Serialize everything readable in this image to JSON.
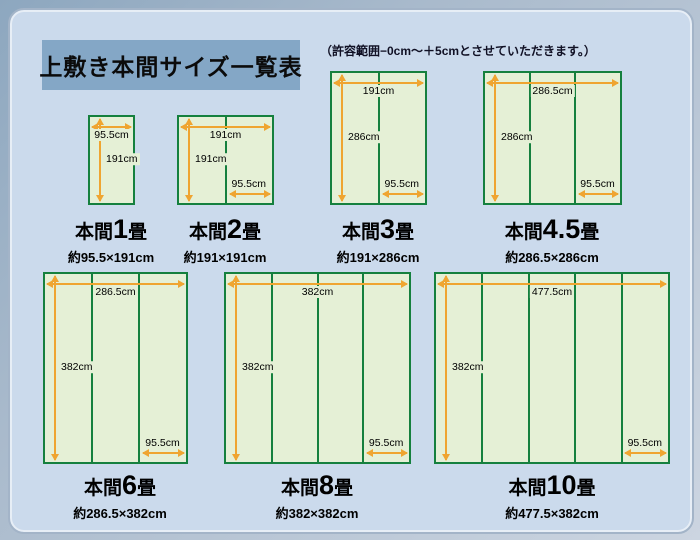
{
  "page": {
    "title": "上敷き本間サイズ一覧表",
    "note": "（許容範囲−0cm〜＋5cmとさせていただきます。）"
  },
  "colors": {
    "panel_background": "#cbdaec",
    "title_box_background": "#84a7c6",
    "mat_fill": "#e5f0d6",
    "mat_border_green": "#15803e",
    "arrow_orange": "#efa531"
  },
  "mats": [
    {
      "id": "honma-1jo",
      "columns": 1,
      "name_prefix": "本間",
      "name_num": "1",
      "name_suffix": "畳",
      "size_label": "約95.5×191cm",
      "width_label": "95.5cm",
      "height_label": "191cm"
    },
    {
      "id": "honma-2jo",
      "columns": 2,
      "name_prefix": "本間",
      "name_num": "2",
      "name_suffix": "畳",
      "size_label": "約191×191cm",
      "width_label": "191cm",
      "height_label": "191cm",
      "bottom_label": "95.5cm"
    },
    {
      "id": "honma-3jo",
      "columns": 2,
      "name_prefix": "本間",
      "name_num": "3",
      "name_suffix": "畳",
      "size_label": "約191×286cm",
      "width_label": "191cm",
      "height_label": "286cm",
      "bottom_label": "95.5cm"
    },
    {
      "id": "honma-4_5jo",
      "columns": 3,
      "name_prefix": "本間",
      "name_num": "4.5",
      "name_suffix": "畳",
      "size_label": "約286.5×286cm",
      "width_label": "286.5cm",
      "height_label": "286cm",
      "bottom_label": "95.5cm"
    },
    {
      "id": "honma-6jo",
      "columns": 3,
      "name_prefix": "本間",
      "name_num": "6",
      "name_suffix": "畳",
      "size_label": "約286.5×382cm",
      "width_label": "286.5cm",
      "height_label": "382cm",
      "bottom_label": "95.5cm"
    },
    {
      "id": "honma-8jo",
      "columns": 4,
      "name_prefix": "本間",
      "name_num": "8",
      "name_suffix": "畳",
      "size_label": "約382×382cm",
      "width_label": "382cm",
      "height_label": "382cm",
      "bottom_label": "95.5cm"
    },
    {
      "id": "honma-10jo",
      "columns": 5,
      "name_prefix": "本間",
      "name_num": "10",
      "name_suffix": "畳",
      "size_label": "約477.5×382cm",
      "width_label": "477.5cm",
      "height_label": "382cm",
      "bottom_label": "95.5cm"
    }
  ]
}
